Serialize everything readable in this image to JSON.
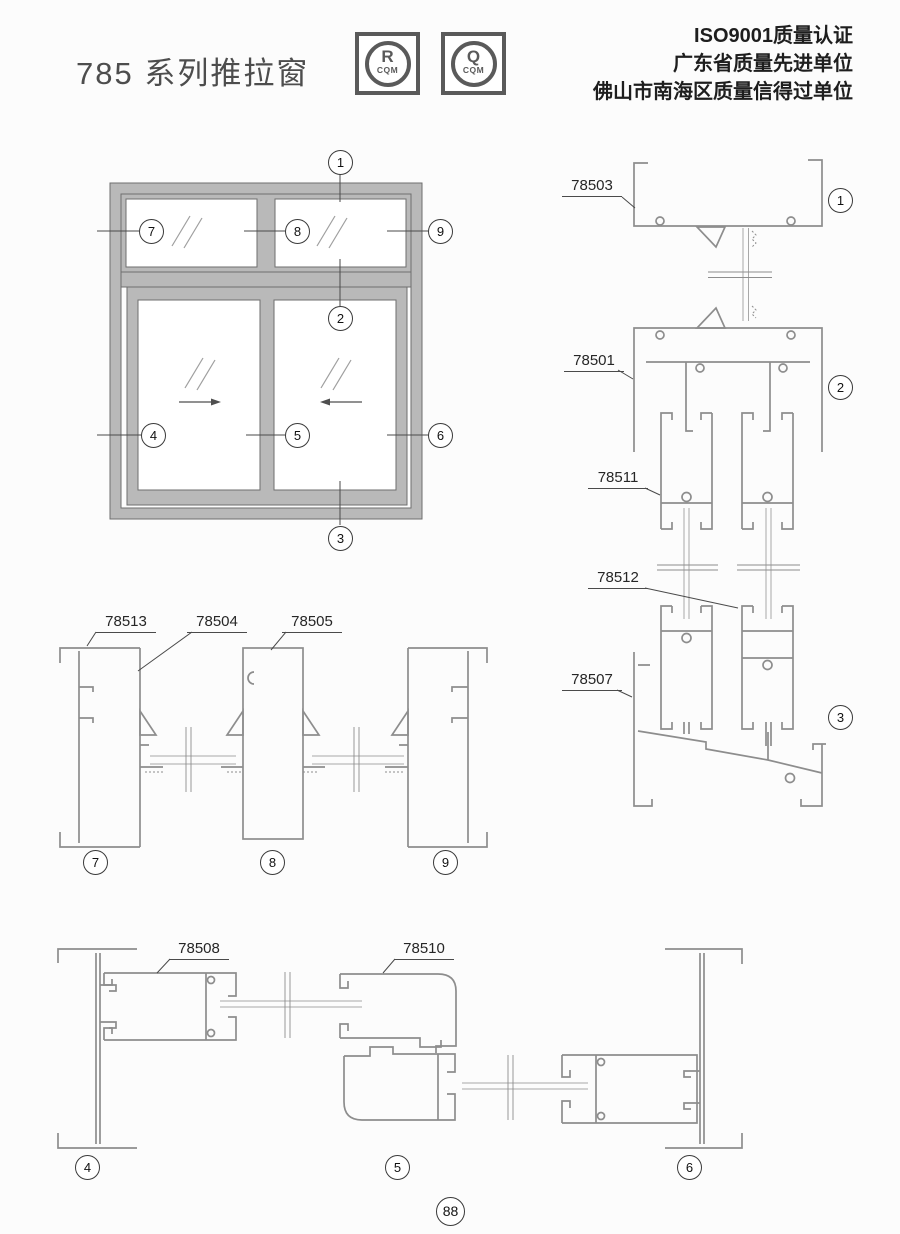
{
  "page": {
    "title": "785 系列推拉窗",
    "page_number": "88",
    "certifications": [
      "ISO9001质量认证",
      "广东省质量先进单位",
      "佛山市南海区质量信得过单位"
    ],
    "logos": [
      {
        "symbol": "R",
        "caption": "CQM"
      },
      {
        "symbol": "Q",
        "caption": "CQM"
      }
    ]
  },
  "elevation": {
    "callouts": [
      "1",
      "2",
      "3",
      "4",
      "5",
      "6",
      "7",
      "8",
      "9"
    ]
  },
  "profiles": {
    "vertical": {
      "labels": [
        "78503",
        "78501",
        "78511",
        "78512",
        "78507"
      ],
      "callouts": [
        "1",
        "2",
        "3"
      ]
    },
    "upper_horizontal": {
      "labels": [
        "78513",
        "78504",
        "78505"
      ],
      "callouts": [
        "7",
        "8",
        "9"
      ]
    },
    "lower_horizontal": {
      "labels": [
        "78508",
        "78510"
      ],
      "callouts": [
        "4",
        "5",
        "6"
      ]
    }
  },
  "colors": {
    "frame_fill": "#b9b9b9",
    "profile_line": "#8d8d8d",
    "text": "#262626"
  }
}
